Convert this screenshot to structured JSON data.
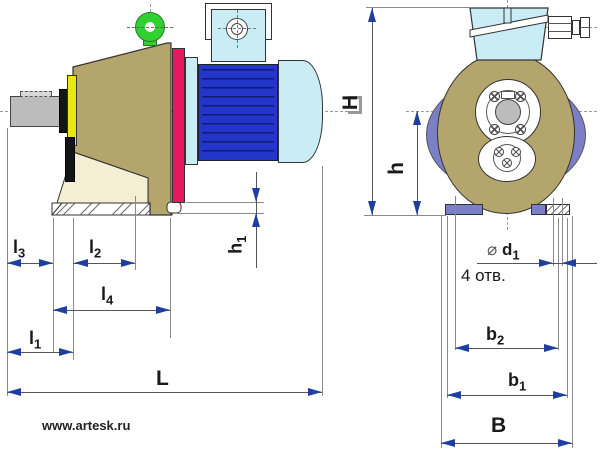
{
  "drawing": {
    "type": "engineering-dimension-drawing",
    "subject": "gear motor (reducer with electric motor), side view and front view",
    "watermark": "www.artesk.ru",
    "holes_note": "4 отв."
  },
  "dimensions": {
    "l3": {
      "main": "l",
      "sub": "3"
    },
    "l2": {
      "main": "l",
      "sub": "2"
    },
    "l4": {
      "main": "l",
      "sub": "4"
    },
    "l1": {
      "main": "l",
      "sub": "1"
    },
    "L": {
      "main": "L",
      "sub": ""
    },
    "h1": {
      "main": "h",
      "sub": "1"
    },
    "h": {
      "main": "h",
      "sub": ""
    },
    "H": {
      "main": "H",
      "sub": ""
    },
    "d1": {
      "prefix": "⌀",
      "main": "d",
      "sub": "1"
    },
    "b2": {
      "main": "b",
      "sub": "2"
    },
    "b1": {
      "main": "b",
      "sub": "1"
    },
    "B": {
      "main": "B",
      "sub": ""
    }
  },
  "colors": {
    "housing_olive": "#b3a56b",
    "gusset_cream": "#f4efd2",
    "flange_pink": "#e8185e",
    "cover_yellow": "#ece70f",
    "seal_black": "#151515",
    "shaft_gray": "#bcbcbc",
    "motor_blue": "#2336cb",
    "motor_light_blue": "#c9ecf5",
    "eyebolt_green": "#2fd02f",
    "feet_periwinkle": "#7b7fc7",
    "arrow_blue": "#1e3f9f",
    "line": "#555555"
  }
}
